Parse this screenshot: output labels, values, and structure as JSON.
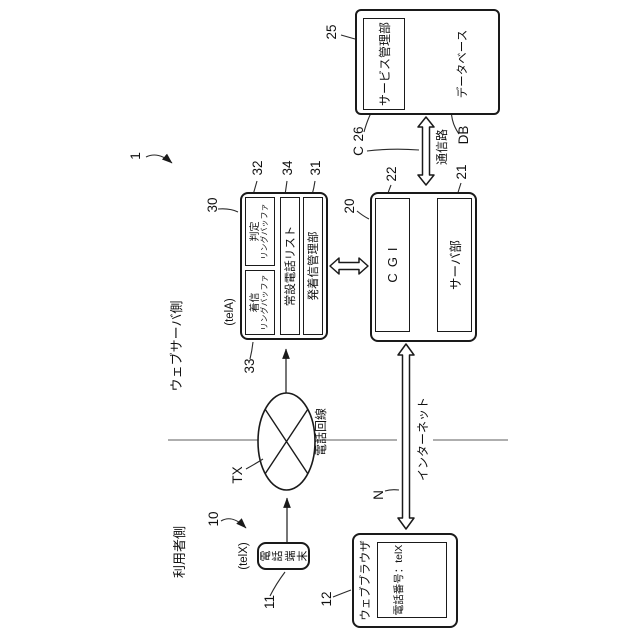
{
  "figure": {
    "ref": "1",
    "side_user": "利用者側",
    "side_server": "ウェブサーバ側"
  },
  "user_side": {
    "group_ref": "10",
    "phone": {
      "ref": "11",
      "tel_id": "(telX)",
      "name": "電話端末"
    },
    "browser": {
      "ref": "12",
      "title": "ウェブブラウザ",
      "field": "電話番号：telX"
    }
  },
  "phone_line": {
    "ref": "TX",
    "label": "電話回線"
  },
  "internet": {
    "ref": "N",
    "label": "インターネット"
  },
  "call_server": {
    "ref": "30",
    "tel_id": "(telA)",
    "incoming_buffer": {
      "ref": "33",
      "name": "着信",
      "type": "リングバッファ"
    },
    "judge_buffer": {
      "ref": "32",
      "name": "判定",
      "type": "リングバッファ"
    },
    "phone_list": {
      "ref": "34",
      "label": "常設電話リスト"
    },
    "call_manager": {
      "ref": "31",
      "label": "発着信管理部"
    }
  },
  "web_server": {
    "ref": "20",
    "cgi": {
      "ref": "22",
      "label": "CGI"
    },
    "server": {
      "ref": "21",
      "label": "サーバ部"
    }
  },
  "channel": {
    "ref": "C",
    "label": "通信路"
  },
  "service": {
    "ref": "25",
    "manager": {
      "ref": "26",
      "label": "サービス管理部"
    },
    "db": {
      "ref": "DB",
      "label": "データベース"
    }
  }
}
